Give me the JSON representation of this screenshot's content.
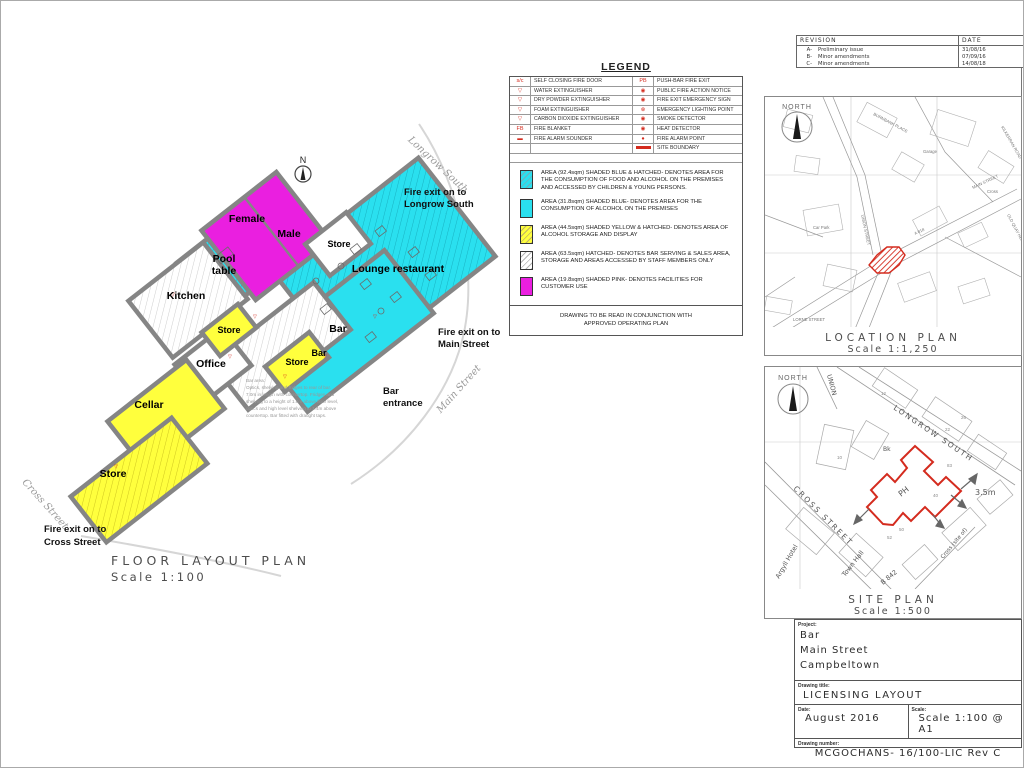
{
  "colors": {
    "area_cyan": "#2ae0ef",
    "area_magenta": "#ea1fe0",
    "area_yellow": "#ffff3d",
    "boundary_red": "#d42b1e",
    "wall_gray": "#858585"
  },
  "revision_block": {
    "header_revision": "REVISION",
    "header_date": "DATE",
    "rows": [
      {
        "rev": "A-",
        "desc": "Preliminary issue",
        "date": "31/08/16"
      },
      {
        "rev": "B-",
        "desc": "Minor amendments",
        "date": "07/09/16"
      },
      {
        "rev": "C-",
        "desc": "Minor amendments",
        "date": "14/08/18"
      }
    ]
  },
  "legend": {
    "title": "LEGEND",
    "rows": [
      {
        "l_sym": "s/c",
        "l_label": "SELF CLOSING FIRE DOOR",
        "r_sym": "PB",
        "r_label": "PUSH-BAR FIRE EXIT"
      },
      {
        "l_sym": "▽",
        "l_label": "WATER EXTINGUISHER",
        "r_sym": "◉",
        "r_label": "PUBLIC FIRE ACTION NOTICE"
      },
      {
        "l_sym": "▽",
        "l_label": "DRY POWDER EXTINGUISHER",
        "r_sym": "◉",
        "r_label": "FIRE EXIT EMERGENCY SIGN"
      },
      {
        "l_sym": "▽",
        "l_label": "FOAM EXTINGUISHER",
        "r_sym": "⊗",
        "r_label": "EMERGENCY LIGHTING POINT"
      },
      {
        "l_sym": "▽",
        "l_label": "CARBON DIOXIDE EXTINGUISHER",
        "r_sym": "◉",
        "r_label": "SMOKE DETECTOR"
      },
      {
        "l_sym": "FB",
        "l_label": "FIRE BLANKET",
        "r_sym": "◉",
        "r_label": "HEAT DETECTOR"
      },
      {
        "l_sym": "▬",
        "l_label": "FIRE ALARM SOUNDER",
        "r_sym": "●",
        "r_label": "FIRE ALARM POINT"
      },
      {
        "l_sym": "",
        "l_label": "",
        "r_sym": "",
        "r_label": "SITE BOUNDARY"
      }
    ],
    "areas": [
      {
        "text": "AREA (92.4sqm) SHADED BLUE & HATCHED- DENOTES AREA FOR THE CONSUMPTION OF FOOD AND ALCOHOL ON THE PREMISES AND ACCESSED BY CHILDREN & YOUNG PERSONS."
      },
      {
        "text": "AREA (31.8sqm) SHADED BLUE- DENOTES AREA FOR THE CONSUMPTION OF ALCOHOL ON THE PREMISES"
      },
      {
        "text": "AREA (44.5sqm) SHADED YELLOW & HATCHED- DENOTES AREA OF ALCOHOL STORAGE AND DISPLAY"
      },
      {
        "text": "AREA (63.5sqm) HATCHED- DENOTES BAR SERVING & SALES AREA, STORAGE AND AREAS ACCESSED BY STAFF MEMBERS ONLY"
      },
      {
        "text": "AREA (19.8sqm) SHADED PINK- DENOTES FACILITIES FOR CUSTOMER USE"
      }
    ],
    "note_line1": "DRAWING TO BE READ IN CONJUNCTION WITH",
    "note_line2": "APPROVED OPERATING PLAN"
  },
  "floor_plan": {
    "north": "N",
    "caption_line1": "FLOOR LAYOUT PLAN",
    "caption_line2": "Scale 1:100",
    "rooms": {
      "female": "Female",
      "male": "Male",
      "pool1": "Pool",
      "pool2": "table",
      "kitchen": "Kitchen",
      "office": "Office",
      "cellar": "Cellar",
      "store": "Store",
      "bar": "Bar",
      "lounge": "Lounge restaurant"
    },
    "exits": {
      "longrow1": "Fire exit on to",
      "longrow2": "Longrow South",
      "main1": "Fire exit on to",
      "main2": "Main Street",
      "cross1": "Fire exit on to",
      "cross2": "Cross Street",
      "entrance1": "Bar",
      "entrance2": "entrance"
    },
    "streets": {
      "longrow": "Longrow South",
      "main": "Main Street",
      "cross": "Cross Street"
    },
    "bar_note": [
      "Bar area:",
      "Optics, shelving and fridges to rear of bar.",
      "7.0m in length with countertop. Fridges and",
      "shelving to a height of 1.0m above floor level,",
      "optics and high level shelving to 1.4m above",
      "countertop. Bar fitted with draught taps."
    ]
  },
  "location_plan": {
    "north": "NORTH",
    "caption_line1": "LOCATION PLAN",
    "caption_line2": "Scale 1:1,250",
    "labels": [
      "MAIN STREET",
      "UNION STREET",
      "BURNBANK PLACE",
      "KILKERRAN ROAD",
      "Car Park",
      "Garage",
      "Cross",
      "OLD QUAY HEAD",
      "A 818",
      "LORNE STREET"
    ]
  },
  "site_plan": {
    "north": "NORTH",
    "caption_line1": "SITE PLAN",
    "caption_line2": "Scale 1:500",
    "labels": {
      "longrow": "LONGROW SOUTH",
      "cross": "CROSS STREET",
      "union": "UNION",
      "town_hall": "Town Hall",
      "argyll": "Argyll Hotel",
      "b842": "B 842",
      "cross_site": "Cross (site of)",
      "depth": "3.5m",
      "ph": "PH",
      "bk": "Bk"
    },
    "numbers": [
      "83",
      "40",
      "52",
      "50",
      "26",
      "22",
      "12",
      "10"
    ]
  },
  "title_block": {
    "project_label": "Project:",
    "project_line1": "Bar",
    "project_line2": "Main Street",
    "project_line3": "Campbeltown",
    "title_label": "Drawing title:",
    "title": "LICENSING LAYOUT",
    "date_label": "Date:",
    "date": "August 2016",
    "scale_label": "Scale:",
    "scale": "Scale 1:100 @ A1",
    "number_label": "Drawing number:",
    "number": "MCGOCHANS- 16/100-LIC Rev C"
  }
}
